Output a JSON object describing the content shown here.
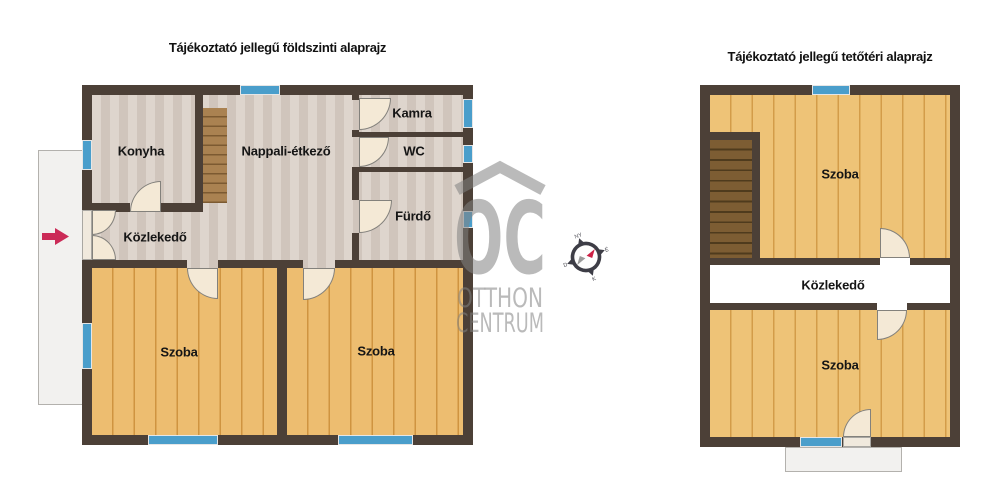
{
  "ground_floor": {
    "title": "Tájékoztató jellegű földszinti alaprajz",
    "rooms": {
      "konyha": "Konyha",
      "nappali": "Nappali-étkező",
      "kamra": "Kamra",
      "wc": "WC",
      "furdo": "Fürdő",
      "kozlekedo": "Közlekedő",
      "szoba_left": "Szoba",
      "szoba_right": "Szoba"
    }
  },
  "attic": {
    "title": "Tájékoztató jellegű tetőtéri alaprajz",
    "rooms": {
      "szoba_top": "Szoba",
      "kozlekedo": "Közlekedő",
      "szoba_bottom": "Szoba"
    }
  },
  "watermark": {
    "monogram": "OC",
    "name_line1": "OTTHON",
    "name_line2": "CENTRUM"
  },
  "compass": {
    "north": "É",
    "east": "K",
    "south": "D",
    "west": "NY"
  },
  "colors": {
    "wall": "#4c4037",
    "floor_beige": "#d8cdc4",
    "floor_wood": "#e8b462",
    "window_blue": "#4a9ecb",
    "door_cream": "#f4e9d6",
    "stairs_ground": "#a8804d",
    "stairs_attic": "#6f5530",
    "terrace_gray": "#f2f1ef",
    "entrance_arrow_red": "#cb2b57",
    "watermark_gray": "#b2b2b2"
  }
}
